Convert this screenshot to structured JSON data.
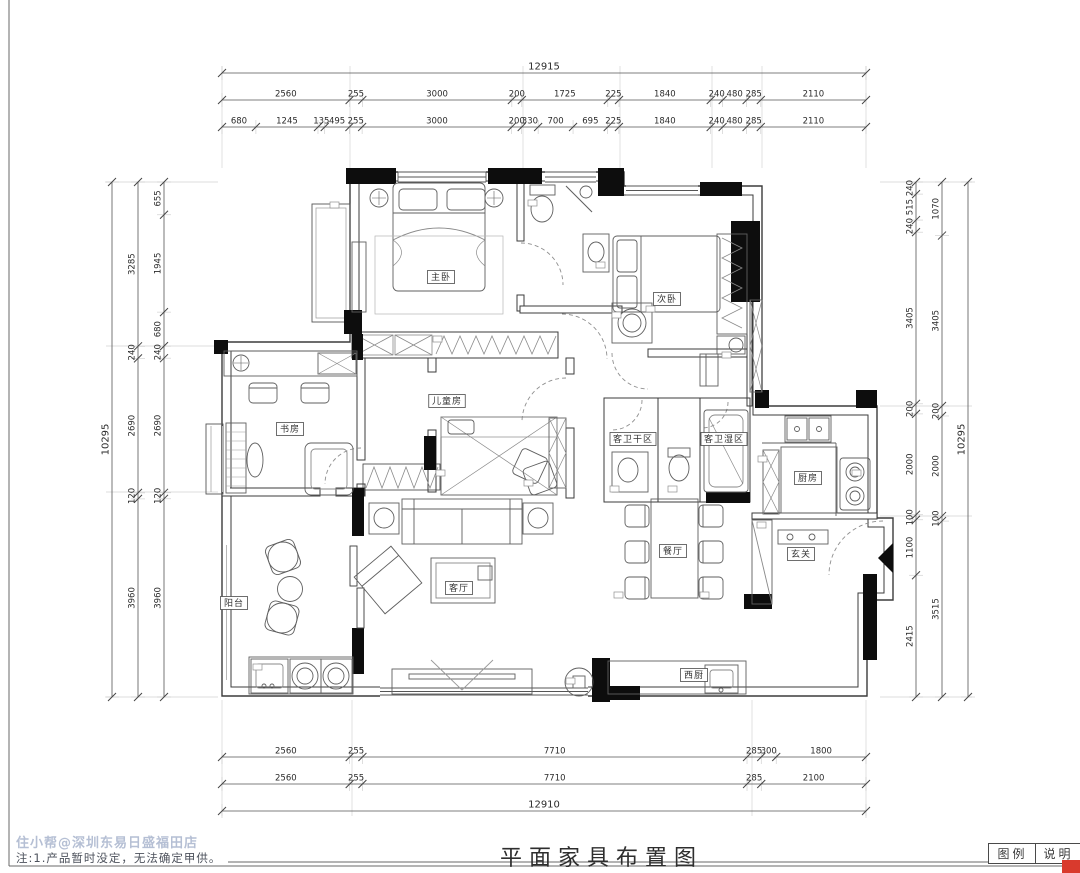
{
  "sheet": {
    "title": "平面家具布置图",
    "legend_label": "图例",
    "notes_label": "说明",
    "watermark": "住小帮@深圳东易日盛福田店",
    "note": "注:1.产品暂时没定，无法确定甲供。"
  },
  "colors": {
    "wall": "#0d0d0d",
    "line": "#3b3b3b",
    "dim_text": "#2b2b2b",
    "watermark": "#b5bfd4",
    "stamp_red": "#d93a2d"
  },
  "dims": {
    "top": {
      "overall": "12915",
      "row2": [
        "2560",
        "255",
        "3000",
        "200",
        "1725",
        "225",
        "1840",
        "240",
        "480",
        "285",
        "2110"
      ],
      "row3": [
        "680",
        "1245",
        "135",
        "495",
        "255",
        "3000",
        "200",
        "330",
        "700",
        "695",
        "225",
        "1840",
        "240",
        "480",
        "285",
        "2110"
      ]
    },
    "bottom": {
      "row1": [
        "2560",
        "255",
        "7710",
        "285",
        "300",
        "1800"
      ],
      "row2": [
        "2560",
        "255",
        "7710",
        "285",
        "2100"
      ],
      "overall": "12910"
    },
    "left": {
      "inner": [
        "655",
        "1945",
        "680",
        "240",
        "2690",
        "120",
        "3960"
      ],
      "mid": [
        "3285",
        "240",
        "2690",
        "120",
        "3960"
      ],
      "overall": "10295"
    },
    "right": {
      "inner": [
        "240",
        "515",
        "240",
        "3405",
        "200",
        "2000",
        "100",
        "1100",
        "2415"
      ],
      "mid": [
        "1070",
        "3405",
        "200",
        "2000",
        "100",
        "3515"
      ],
      "outer": "10295"
    }
  },
  "rooms": [
    {
      "id": "master-bedroom",
      "name": "主卧",
      "x": 441,
      "y": 277
    },
    {
      "id": "second-bedroom",
      "name": "次卧",
      "x": 667,
      "y": 299
    },
    {
      "id": "kids-room",
      "name": "儿童房",
      "x": 447,
      "y": 401
    },
    {
      "id": "study",
      "name": "书房",
      "x": 290,
      "y": 429
    },
    {
      "id": "guest-bath-dry",
      "name": "客卫干区",
      "x": 633,
      "y": 439
    },
    {
      "id": "guest-bath-wet",
      "name": "客卫湿区",
      "x": 724,
      "y": 439
    },
    {
      "id": "kitchen",
      "name": "厨房",
      "x": 808,
      "y": 478
    },
    {
      "id": "foyer",
      "name": "玄关",
      "x": 801,
      "y": 554
    },
    {
      "id": "dining-room",
      "name": "餐厅",
      "x": 673,
      "y": 551
    },
    {
      "id": "living-room",
      "name": "客厅",
      "x": 459,
      "y": 588
    },
    {
      "id": "balcony",
      "name": "阳台",
      "x": 234,
      "y": 603
    },
    {
      "id": "west-kitchen",
      "name": "西厨",
      "x": 694,
      "y": 675
    }
  ]
}
